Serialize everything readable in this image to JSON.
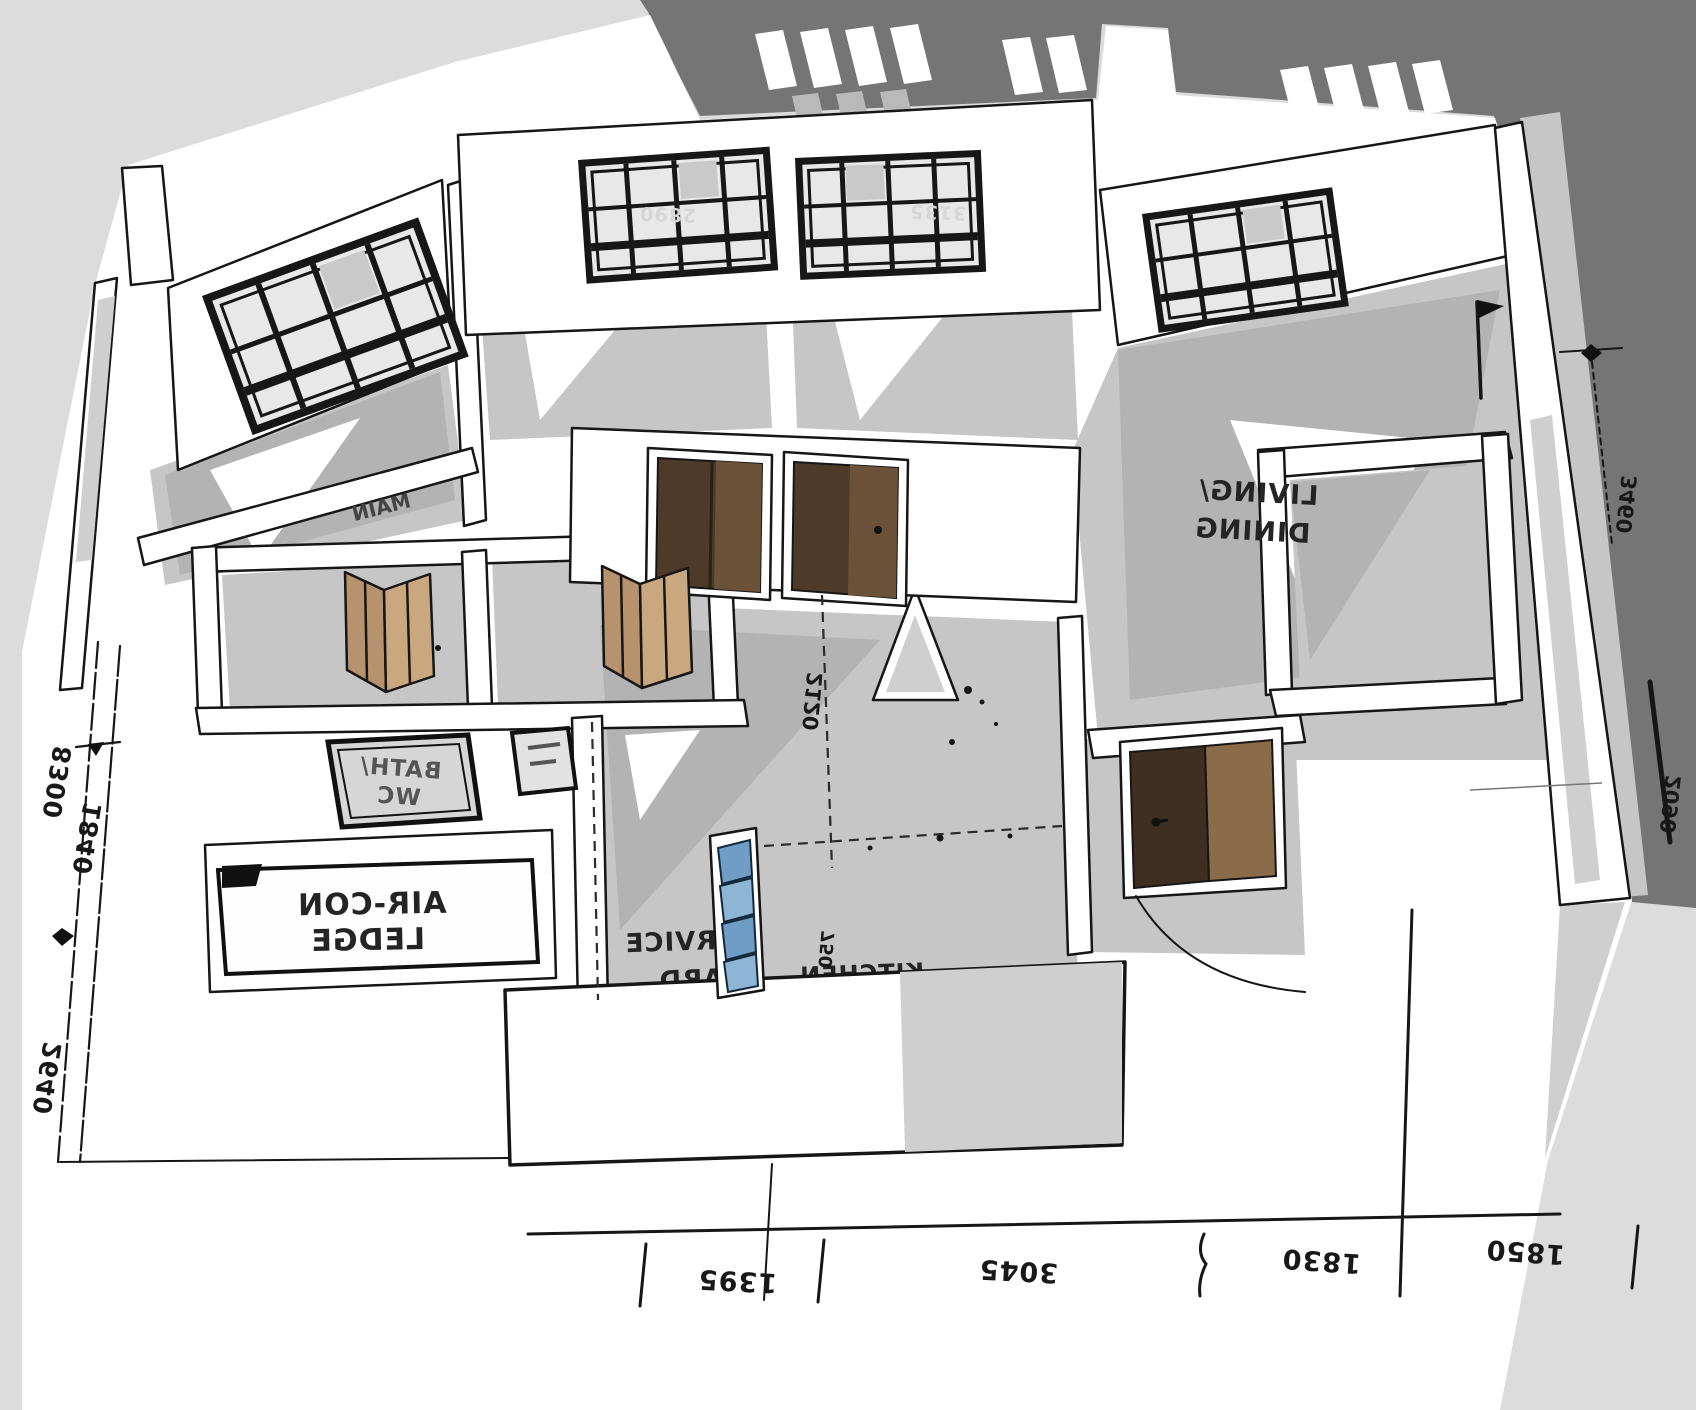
{
  "viewport": {
    "kind": "3d-floor-plan-model"
  },
  "labels": {
    "living1": "LIVING/",
    "living2": "DINING",
    "bath1": "BATH/",
    "bath2": "WC",
    "aircon1": "AIR-CON",
    "aircon2": "LEDGE",
    "service1": "SERVICE",
    "service2": "YARD",
    "kitchen": "KITCHEN",
    "main": "MAIN"
  },
  "dims": {
    "bottom": [
      "1395",
      "3045",
      "1830",
      "1850"
    ],
    "left": [
      "8300",
      "1840",
      "2640"
    ],
    "right": [
      "3460",
      "2090"
    ],
    "center": "2120",
    "kitchen": "750",
    "window2": "2890",
    "window3": "3135"
  },
  "colors": {
    "background": "#dcdcdc",
    "dark_band": "#757575",
    "mid_band": "#b9b9b9",
    "paper": "#ffffff",
    "floor": "#c6c6c6",
    "floor_shadow": "#b3b3b3",
    "window_frame": "#171717",
    "door_dark": "#4e3a29",
    "door_light": "#8a6b4a",
    "bifold_tan": "#b6926d",
    "louvre_blue": "#6f9dc6",
    "ink": "#161616"
  }
}
